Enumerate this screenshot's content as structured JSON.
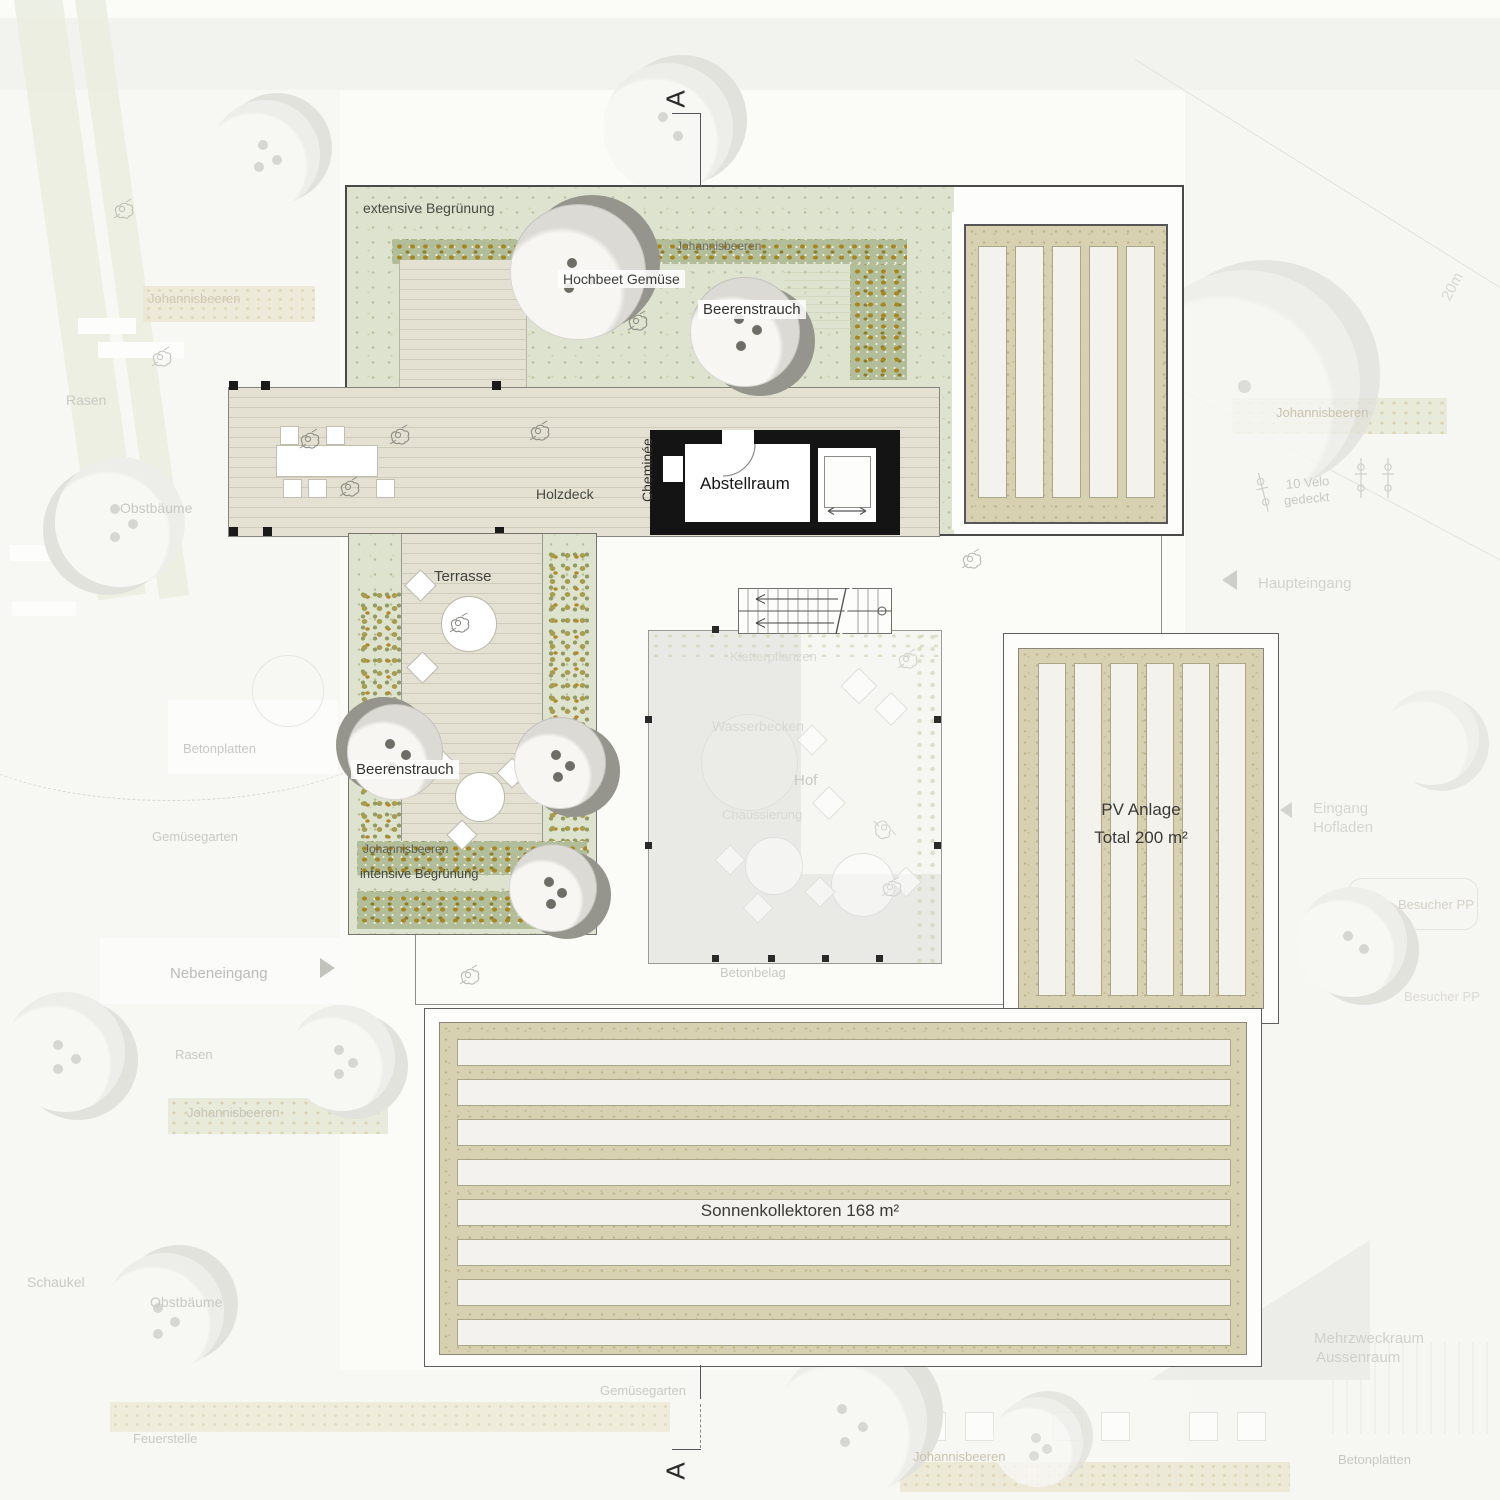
{
  "plan": {
    "roof_garden": {
      "extensive_label": "extensive Begrünung",
      "hedge_label": "Johannisbeeren",
      "raised_bed_label": "Hochbeet Gemüse",
      "berry_bush_label": "Beerenstrauch"
    },
    "deck": {
      "label": "Holzdeck",
      "chimney_label": "Cheminée"
    },
    "storage": {
      "label": "Abstellraum"
    },
    "terrace": {
      "label": "Terrasse",
      "berry_bush_label": "Beerenstrauch",
      "currant_label": "Johannisbeeren",
      "intensive_label": "intensive Begrünung"
    },
    "courtyard": {
      "climbing_label": "Kletterpflanzen",
      "basin_label": "Wasserbecken",
      "label": "Hof",
      "paving_label": "Chaussierung",
      "concrete_label": "Betonbelag"
    },
    "pv": {
      "line1": "PV Anlage",
      "line2": "Total 200 m²"
    },
    "solar": {
      "label": "Sonnenkollektoren 168 m²"
    },
    "section": {
      "top": "A",
      "bottom": "A"
    }
  },
  "background_labels": {
    "johannisbeeren_nw": "Johannisbeeren",
    "rasen_w": "Rasen",
    "obstbaeume_w": "Obstbäume",
    "betonplatten_w": "Betonplatten",
    "gemuesegarten_w": "Gemüsegarten",
    "nebeneingang": "Nebeneingang",
    "rasen_sw": "Rasen",
    "johannisbeeren_sw": "Johannisbeeren",
    "schaukel": "Schaukel",
    "obstbaeume_sw": "Obstbäume",
    "feuerstelle": "Feuerstelle",
    "gemuesegarten_s": "Gemüsegarten",
    "johannisbeeren_s": "Johannisbeeren",
    "johannisbeeren_ne": "Johannisbeeren",
    "velo_line1": "10 Velo",
    "velo_line2": "gedeckt",
    "haupteingang": "Haupteingang",
    "eingang_line1": "Eingang",
    "eingang_line2": "Hofladen",
    "besucher_pp_1": "Besucher PP",
    "besucher_pp_2": "Besucher PP",
    "mehrzweck_line1": "Mehrzweckraum",
    "mehrzweck_line2": "Aussenraum",
    "betonplatten_se": "Betonplatten",
    "scale_20m": "20m"
  },
  "colors": {
    "roof_green": "#dee3cf",
    "hedge_green": "#b2bd99",
    "ochre_speckle": "#a8861f",
    "deck_wood": "#e4e1d3",
    "solar_beige": "#d7d1b2",
    "panel_white": "#f3f2ed",
    "wall_black": "#141414",
    "frame_dark": "#4a4a48",
    "faint_text": "#c9c9c3"
  }
}
